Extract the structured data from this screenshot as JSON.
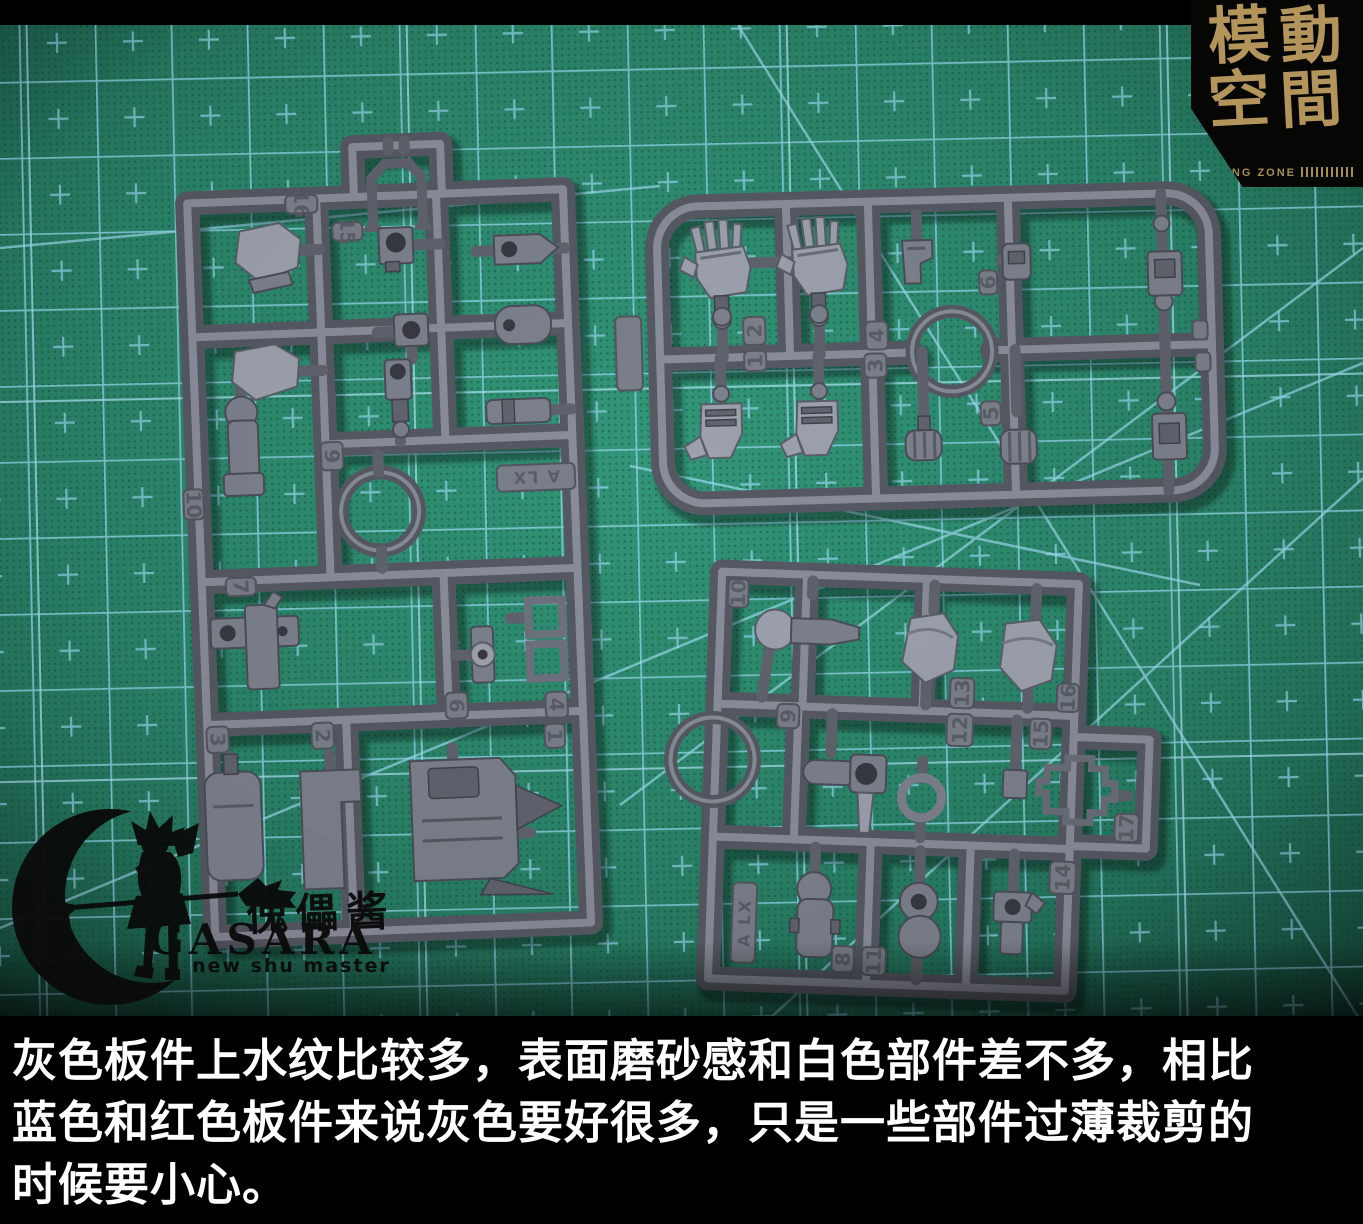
{
  "colors": {
    "mat_green": "#2b8a6e",
    "grid_blue": "#8fd3e9",
    "sprue_grey": "#6e727e",
    "logo_gold": "#b3955c",
    "caption_text": "#ffffff",
    "background": "#000000"
  },
  "caption": {
    "lines": [
      "灰色板件上水纹比较多，表面磨砂感和白色部件差不多，相比",
      "蓝色和红色板件来说灰色要好很多，只是一些部件过薄裁剪的",
      "时候要小心。"
    ]
  },
  "logo": {
    "chars": [
      "模",
      "動",
      "空",
      "間"
    ],
    "tagline": "SAYING ZONE"
  },
  "watermark": {
    "calligraphy": "傀儡酱",
    "brand": "GASARA",
    "subtitle": "new shu master"
  },
  "sprues": {
    "left": {
      "tag": "A LX",
      "tabs": [
        "16",
        "15",
        "10",
        "9",
        "7",
        "3",
        "2",
        "6",
        "4",
        "1"
      ]
    },
    "top_right": {
      "tabs": [
        "2",
        "1",
        "4",
        "3",
        "6",
        "5"
      ]
    },
    "bottom_right": {
      "tag": "A LX",
      "tabs": [
        "10",
        "9",
        "13",
        "12",
        "16",
        "15",
        "17",
        "14",
        "8",
        "11"
      ]
    }
  }
}
